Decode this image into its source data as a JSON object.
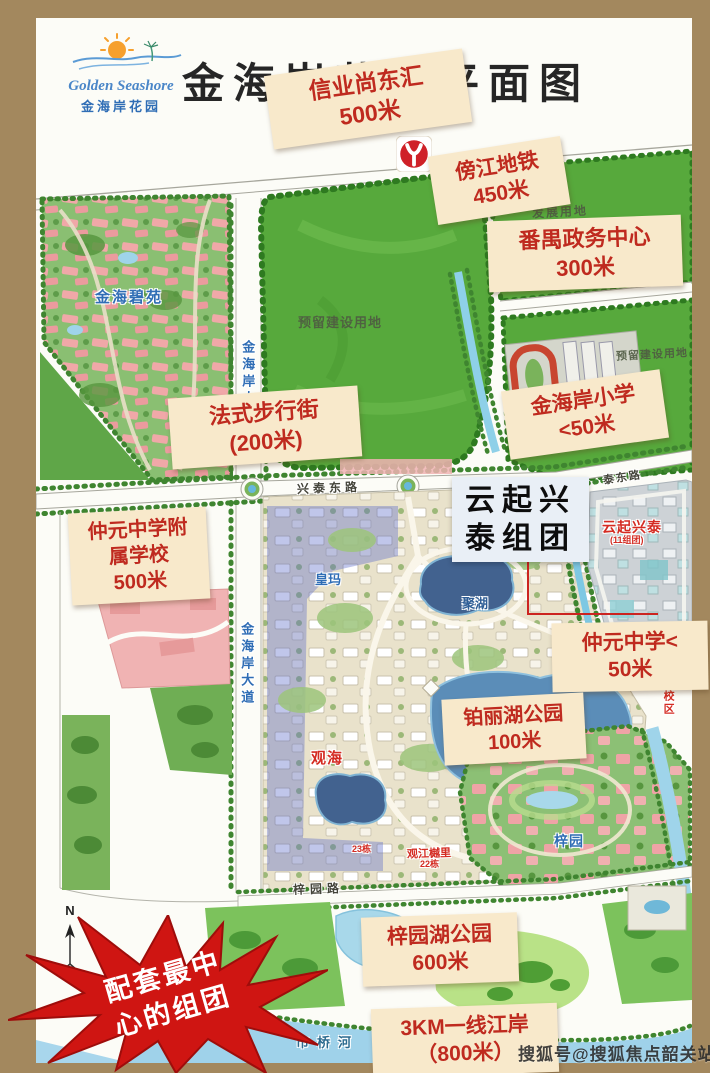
{
  "header": {
    "logo": {
      "en": "Golden Seashore",
      "cn": "金海岸花园"
    },
    "title": "金海岸花园平面图"
  },
  "callouts": {
    "xinye": {
      "line1": "信业尚东汇",
      "line2": "500米"
    },
    "metro": {
      "line1": "傍江地铁",
      "line2": "450米"
    },
    "panyu": {
      "line1": "番禺政务中心",
      "line2": "300米"
    },
    "street": {
      "line1": "法式步行街",
      "line2": "(200米)"
    },
    "primary": {
      "line1": "金海岸小学",
      "line2": "<50米"
    },
    "affiliated": {
      "line1": "仲元中学附",
      "line2": "属学校",
      "line3": "500米"
    },
    "zhongyuan": {
      "line1": "仲元中学<",
      "line2": "50米"
    },
    "bolihu": {
      "line1": "铂丽湖公园",
      "line2": "100米"
    },
    "ziyuanhu": {
      "line1": "梓园湖公园",
      "line2": "600米"
    },
    "riverside": {
      "line1": "3KM一线江岸",
      "line2": "（800米）"
    }
  },
  "cluster_box": {
    "line1": "云起兴",
    "line2": "泰组团"
  },
  "starburst": {
    "line1": "配套最中",
    "line2": "心的组团"
  },
  "map_labels": {
    "development_land": "发展用地",
    "reserved_land_top": "预留建设用地",
    "reserved_land_right": "预留建设用地",
    "jinhai_biyuan": "金海碧苑",
    "blvd_upper": "金海岸大道",
    "blvd_lower": "金海岸大道",
    "xingtai_east_rd": "兴泰东路",
    "tai_east_rd": "泰东路",
    "yunqi_xingtai": "云起兴泰",
    "yunqi_sub": "(11组团)",
    "huangma": "皇玛",
    "juhu": "聚湖",
    "guanhai": "观海",
    "block23": "23栋",
    "guanjiang_yueli": "观江樾里",
    "block22": "22栋",
    "ziyuan": "梓园",
    "ziyuan_rd": "梓园路",
    "shiqiao_river": "市桥河",
    "campus_one": "一校区",
    "compass_n": "N"
  },
  "watermark": "搜狐号@搜狐焦点韶关站",
  "colors": {
    "frame": "#a3885e",
    "callout_bg": "#f8e9cb",
    "callout_text": "#bf2a1f",
    "field_green": "#57a93c",
    "river_water": "#9fd2ea",
    "lake_deep": "#42628f",
    "starburst_red": "#cf1512",
    "metro_red": "#cf2128"
  }
}
